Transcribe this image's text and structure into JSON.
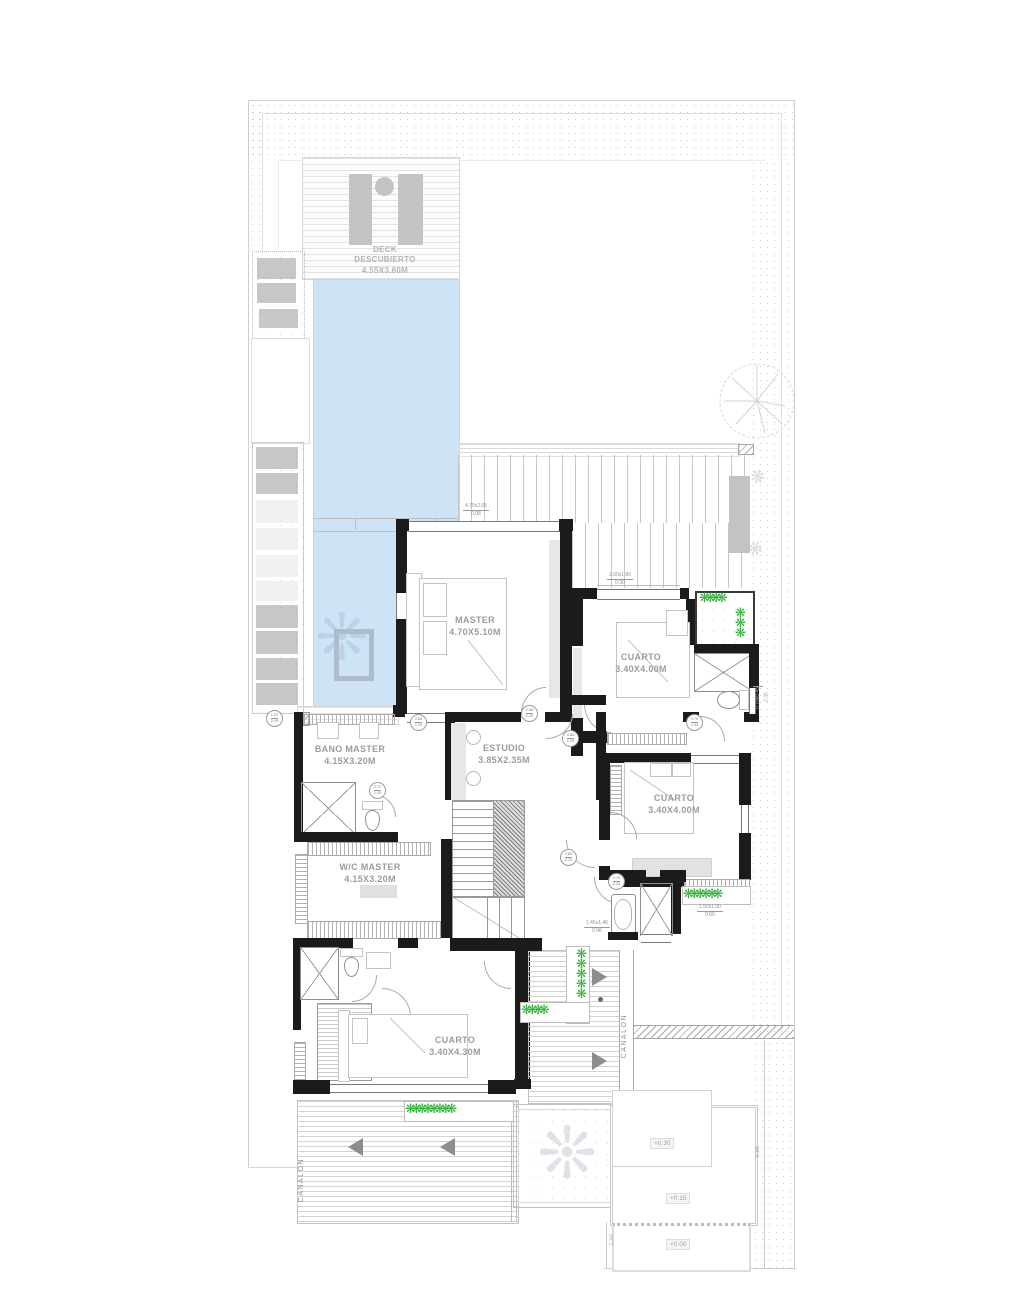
{
  "plan": {
    "deck": {
      "line1": "DECK",
      "line2": "DESCUBIERTO",
      "line3": "4.55X3.60M"
    },
    "rooms": {
      "master": {
        "name": "MASTER",
        "size": "4.70X5.10M"
      },
      "cuarto1": {
        "name": "CUARTO",
        "size": "3.40X4.00M"
      },
      "cuarto2": {
        "name": "CUARTO",
        "size": "3.40X4.00M"
      },
      "cuarto3": {
        "name": "CUARTO",
        "size": "3.40X4.30M"
      },
      "bano_master": {
        "name": "BANO MASTER",
        "size": "4.15X3.20M"
      },
      "wc_master": {
        "name": "W/C MASTER",
        "size": "4.15X3.20M"
      },
      "estudio": {
        "name": "ESTUDIO",
        "size": "3.85X2.35M"
      }
    },
    "door_tags": {
      "t1": {
        "w": "1.20",
        "h": "2.05"
      },
      "t2": {
        "w": "0.88",
        "h": "2.20"
      },
      "t3": {
        "w": "0.88",
        "h": "2.35"
      },
      "t4": {
        "w": "0.88",
        "h": "2.35"
      },
      "t5": {
        "w": "0.75",
        "h": "2.35"
      },
      "t6": {
        "w": "0.88",
        "h": "2.20"
      },
      "t7": {
        "w": "0.70",
        "h": "2.35"
      },
      "t8": {
        "w": "0.70",
        "h": "2.05"
      }
    },
    "window_dims": {
      "w1": {
        "size": "4.70x2.05",
        "sill": "0.08"
      },
      "w2": {
        "size": "2.00x1.80",
        "sill": "0.90"
      },
      "w3": {
        "size": "0.70x0.45",
        "sill": "2.05"
      },
      "w4": {
        "size": "1.45x1.46",
        "sill": "0.96"
      },
      "w5": {
        "size": "1.50x1.00",
        "sill": "0.60"
      }
    },
    "levels": {
      "terrace": "+0.30",
      "patio": "+0.15",
      "ground": "+0.00"
    },
    "site_dims": {
      "d1": "6.88",
      "d2": "1.50"
    },
    "labels": {
      "canalon_left": "CANALON",
      "canalon_right": "CANALON"
    },
    "glyphs": {
      "hedge_row_lg": "❋❋❋❋❋❋❋❋",
      "hedge_row_md": "❋❋❋❋❋❋",
      "hedge_row_sm": "❋❋❋❋",
      "hedge_col": "❋❋❋❋❋",
      "planter_top": "❋❋❋❋",
      "planter_side": "❋❋❋",
      "palm": "❊",
      "fern": "❋"
    },
    "colors": {
      "pool": "#cfe3f7",
      "plant": "#2fae38",
      "wall": "#1b1b1b"
    }
  }
}
